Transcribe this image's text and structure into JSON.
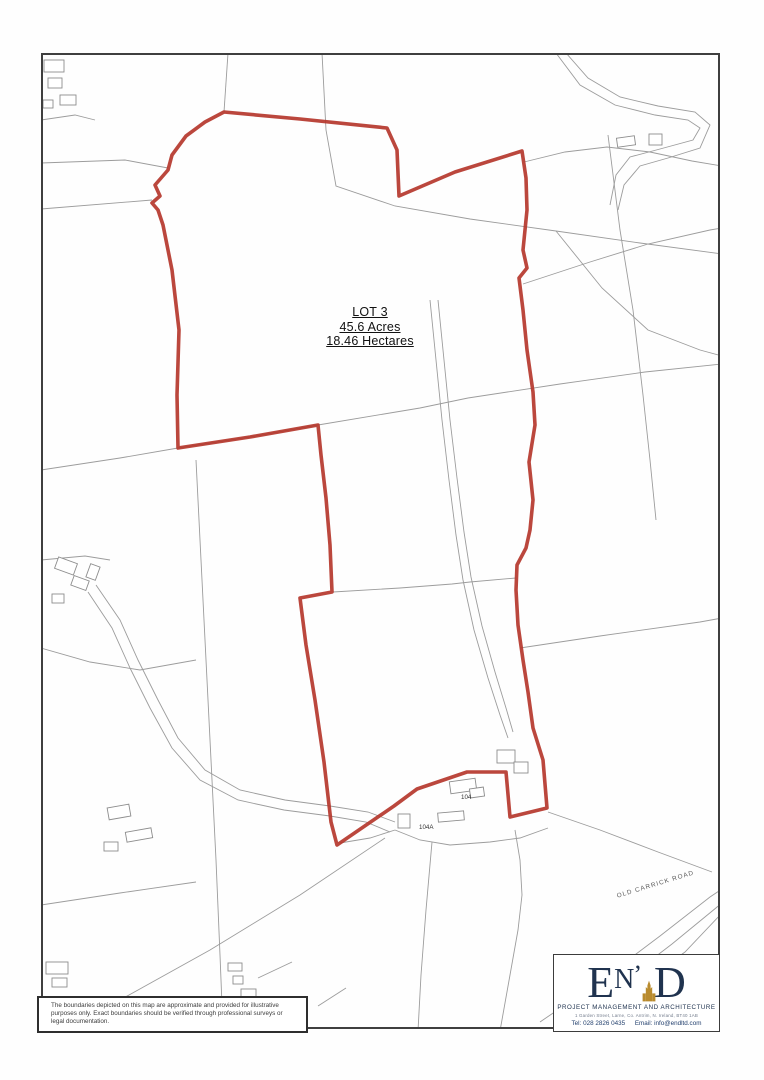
{
  "map": {
    "boundary_color": "#b5372c",
    "line_color": "#9c9c9c",
    "building_stroke": "#8d8d8d",
    "frame_color": "#3f3f3f",
    "lot_label": {
      "line1": "LOT 3",
      "line2": "45.6 Acres",
      "line3": "18.46 Hectares"
    },
    "road_label": {
      "text": "OLD CARRICK ROAD",
      "x": 656,
      "y": 886,
      "rotate": -17
    },
    "building_labels": [
      {
        "text": "104",
        "x": 461,
        "y": 799
      },
      {
        "text": "104A",
        "x": 419,
        "y": 829
      }
    ],
    "red_boundary": [
      [
        224,
        112
      ],
      [
        300,
        119
      ],
      [
        387,
        128
      ],
      [
        397,
        150
      ],
      [
        399,
        196
      ],
      [
        455,
        172
      ],
      [
        522,
        151
      ],
      [
        526,
        178
      ],
      [
        527,
        210
      ],
      [
        523,
        250
      ],
      [
        527,
        268
      ],
      [
        519,
        278
      ],
      [
        523,
        310
      ],
      [
        527,
        350
      ],
      [
        533,
        392
      ],
      [
        535,
        425
      ],
      [
        529,
        462
      ],
      [
        533,
        500
      ],
      [
        530,
        530
      ],
      [
        526,
        548
      ],
      [
        517,
        565
      ],
      [
        516,
        590
      ],
      [
        518,
        625
      ],
      [
        523,
        660
      ],
      [
        528,
        692
      ],
      [
        533,
        728
      ],
      [
        543,
        760
      ],
      [
        547,
        808
      ],
      [
        510,
        817
      ],
      [
        506,
        772
      ],
      [
        467,
        772
      ],
      [
        417,
        789
      ],
      [
        394,
        806
      ],
      [
        337,
        845
      ],
      [
        331,
        822
      ],
      [
        324,
        762
      ],
      [
        315,
        700
      ],
      [
        306,
        645
      ],
      [
        300,
        598
      ],
      [
        332,
        592
      ],
      [
        330,
        545
      ],
      [
        326,
        498
      ],
      [
        321,
        455
      ],
      [
        318,
        425
      ],
      [
        250,
        437
      ],
      [
        178,
        448
      ],
      [
        177,
        395
      ],
      [
        179,
        330
      ],
      [
        172,
        270
      ],
      [
        163,
        225
      ],
      [
        158,
        210
      ],
      [
        152,
        203
      ],
      [
        160,
        196
      ],
      [
        155,
        185
      ],
      [
        168,
        170
      ],
      [
        172,
        155
      ],
      [
        186,
        136
      ],
      [
        205,
        122
      ]
    ],
    "grey_lines": [
      [
        [
          41,
          163
        ],
        [
          125,
          160
        ],
        [
          168,
          168
        ]
      ],
      [
        [
          41,
          209
        ],
        [
          152,
          200
        ]
      ],
      [
        [
          228,
          53
        ],
        [
          224,
          112
        ]
      ],
      [
        [
          322,
          53
        ],
        [
          326,
          130
        ],
        [
          336,
          186
        ],
        [
          395,
          206
        ],
        [
          470,
          219
        ],
        [
          556,
          231
        ],
        [
          640,
          243
        ],
        [
          722,
          254
        ]
      ],
      [
        [
          556,
          231
        ],
        [
          602,
          288
        ],
        [
          648,
          330
        ],
        [
          700,
          350
        ],
        [
          722,
          356
        ]
      ],
      [
        [
          41,
          470
        ],
        [
          120,
          458
        ],
        [
          178,
          448
        ],
        [
          250,
          437
        ],
        [
          318,
          425
        ],
        [
          420,
          408
        ],
        [
          468,
          398
        ]
      ],
      [
        [
          468,
          398
        ],
        [
          560,
          384
        ],
        [
          645,
          372
        ],
        [
          722,
          364
        ]
      ],
      [
        [
          524,
          162
        ],
        [
          565,
          152
        ],
        [
          607,
          147
        ],
        [
          650,
          152
        ],
        [
          692,
          161
        ],
        [
          722,
          166
        ]
      ],
      [
        [
          608,
          135
        ],
        [
          620,
          230
        ],
        [
          633,
          310
        ],
        [
          643,
          395
        ],
        [
          650,
          460
        ],
        [
          656,
          520
        ]
      ],
      [
        [
          523,
          284
        ],
        [
          590,
          262
        ],
        [
          648,
          244
        ],
        [
          710,
          230
        ],
        [
          722,
          228
        ]
      ],
      [
        [
          556,
          53
        ],
        [
          580,
          85
        ],
        [
          615,
          105
        ],
        [
          655,
          115
        ],
        [
          688,
          120
        ],
        [
          700,
          128
        ],
        [
          693,
          140
        ],
        [
          660,
          149
        ],
        [
          630,
          157
        ],
        [
          616,
          175
        ],
        [
          610,
          205
        ]
      ],
      [
        [
          566,
          53
        ],
        [
          588,
          78
        ],
        [
          620,
          97
        ],
        [
          658,
          106
        ],
        [
          695,
          112
        ],
        [
          710,
          125
        ],
        [
          700,
          148
        ],
        [
          668,
          158
        ],
        [
          640,
          166
        ],
        [
          624,
          185
        ],
        [
          618,
          210
        ]
      ],
      [
        [
          430,
          300
        ],
        [
          436,
          360
        ],
        [
          442,
          420
        ],
        [
          449,
          480
        ],
        [
          456,
          535
        ],
        [
          463,
          580
        ],
        [
          474,
          630
        ],
        [
          488,
          678
        ],
        [
          500,
          715
        ],
        [
          508,
          738
        ]
      ],
      [
        [
          438,
          300
        ],
        [
          444,
          360
        ],
        [
          450,
          420
        ],
        [
          457,
          478
        ],
        [
          464,
          532
        ],
        [
          471,
          577
        ],
        [
          482,
          626
        ],
        [
          495,
          672
        ],
        [
          506,
          708
        ],
        [
          513,
          732
        ]
      ],
      [
        [
          333,
          592
        ],
        [
          400,
          588
        ],
        [
          452,
          584
        ],
        [
          470,
          582
        ],
        [
          516,
          578
        ]
      ],
      [
        [
          41,
          560
        ],
        [
          85,
          556
        ],
        [
          110,
          560
        ]
      ],
      [
        [
          96,
          585
        ],
        [
          120,
          620
        ],
        [
          138,
          660
        ],
        [
          158,
          700
        ],
        [
          178,
          738
        ],
        [
          205,
          770
        ],
        [
          240,
          790
        ],
        [
          285,
          800
        ],
        [
          330,
          806
        ],
        [
          368,
          812
        ],
        [
          395,
          822
        ]
      ],
      [
        [
          88,
          592
        ],
        [
          112,
          628
        ],
        [
          130,
          668
        ],
        [
          150,
          708
        ],
        [
          172,
          748
        ],
        [
          200,
          780
        ],
        [
          238,
          800
        ],
        [
          284,
          810
        ],
        [
          330,
          816
        ],
        [
          366,
          822
        ],
        [
          390,
          832
        ]
      ],
      [
        [
          196,
          460
        ],
        [
          201,
          560
        ],
        [
          206,
          660
        ],
        [
          211,
          760
        ],
        [
          216,
          860
        ],
        [
          220,
          955
        ],
        [
          222,
          1005
        ],
        [
          223,
          1031
        ]
      ],
      [
        [
          41,
          648
        ],
        [
          90,
          662
        ],
        [
          140,
          670
        ],
        [
          196,
          660
        ]
      ],
      [
        [
          41,
          905
        ],
        [
          120,
          893
        ],
        [
          196,
          882
        ]
      ],
      [
        [
          385,
          838
        ],
        [
          300,
          895
        ],
        [
          210,
          950
        ],
        [
          120,
          1000
        ],
        [
          60,
          1026
        ]
      ],
      [
        [
          432,
          842
        ],
        [
          426,
          910
        ],
        [
          421,
          975
        ],
        [
          418,
          1031
        ]
      ],
      [
        [
          500,
          1031
        ],
        [
          510,
          975
        ],
        [
          518,
          930
        ],
        [
          522,
          895
        ],
        [
          520,
          860
        ],
        [
          515,
          830
        ]
      ],
      [
        [
          540,
          1022
        ],
        [
          600,
          981
        ],
        [
          660,
          936
        ],
        [
          710,
          897
        ],
        [
          722,
          889
        ]
      ],
      [
        [
          552,
          1031
        ],
        [
          612,
          990
        ],
        [
          672,
          944
        ],
        [
          722,
          903
        ]
      ],
      [
        [
          561,
          1031
        ],
        [
          620,
          999
        ],
        [
          685,
          952
        ],
        [
          722,
          913
        ]
      ],
      [
        [
          548,
          812
        ],
        [
          600,
          830
        ],
        [
          658,
          852
        ],
        [
          712,
          872
        ]
      ],
      [
        [
          520,
          648
        ],
        [
          600,
          636
        ],
        [
          700,
          622
        ],
        [
          722,
          618
        ]
      ],
      [
        [
          340,
          843
        ],
        [
          370,
          838
        ],
        [
          395,
          830
        ]
      ],
      [
        [
          395,
          830
        ],
        [
          420,
          840
        ],
        [
          450,
          845
        ],
        [
          490,
          842
        ],
        [
          520,
          838
        ],
        [
          548,
          828
        ]
      ],
      [
        [
          258,
          978
        ],
        [
          292,
          962
        ]
      ],
      [
        [
          318,
          1006
        ],
        [
          346,
          988
        ]
      ],
      [
        [
          41,
          120
        ],
        [
          75,
          115
        ],
        [
          95,
          120
        ]
      ]
    ],
    "buildings": [
      [
        44,
        60,
        20,
        12,
        0
      ],
      [
        48,
        78,
        14,
        10,
        0
      ],
      [
        60,
        95,
        16,
        10,
        0
      ],
      [
        43,
        100,
        10,
        8,
        0
      ],
      [
        617,
        137,
        18,
        9,
        -8
      ],
      [
        649,
        134,
        13,
        11,
        0
      ],
      [
        56,
        560,
        20,
        12,
        20
      ],
      [
        72,
        578,
        16,
        10,
        20
      ],
      [
        52,
        594,
        12,
        9,
        0
      ],
      [
        88,
        565,
        10,
        14,
        20
      ],
      [
        108,
        806,
        22,
        12,
        -10
      ],
      [
        126,
        830,
        26,
        10,
        -10
      ],
      [
        104,
        842,
        14,
        9,
        0
      ],
      [
        450,
        780,
        26,
        12,
        -8
      ],
      [
        497,
        750,
        18,
        13,
        0
      ],
      [
        514,
        762,
        14,
        11,
        0
      ],
      [
        438,
        812,
        26,
        9,
        -5
      ],
      [
        398,
        814,
        12,
        14,
        0
      ],
      [
        470,
        788,
        14,
        9,
        -8
      ],
      [
        228,
        963,
        14,
        8,
        0
      ],
      [
        233,
        976,
        10,
        8,
        0
      ],
      [
        241,
        989,
        15,
        8,
        0
      ],
      [
        46,
        962,
        22,
        12,
        0
      ],
      [
        52,
        978,
        15,
        9,
        0
      ]
    ]
  },
  "disclaimer": {
    "line1": "The boundaries depicted on this map are approximate and provided for illustrative",
    "line2": "purposes only. Exact boundaries should be verified through professional surveys or",
    "line3": "legal documentation."
  },
  "logo": {
    "letter_e": "E",
    "letter_n": "N",
    "apostrophe": "’",
    "letter_d": "D",
    "tagline": "PROJECT MANAGEMENT AND ARCHITECTURE",
    "address": "1 Garden Street, Larne, Co. Antrim, N. Ireland, BT40 1AB",
    "tel": "Tel: 028 2826 0435",
    "email": "Email: info@endltd.com",
    "navy": "#20334f",
    "gold": "#b98b2e"
  }
}
